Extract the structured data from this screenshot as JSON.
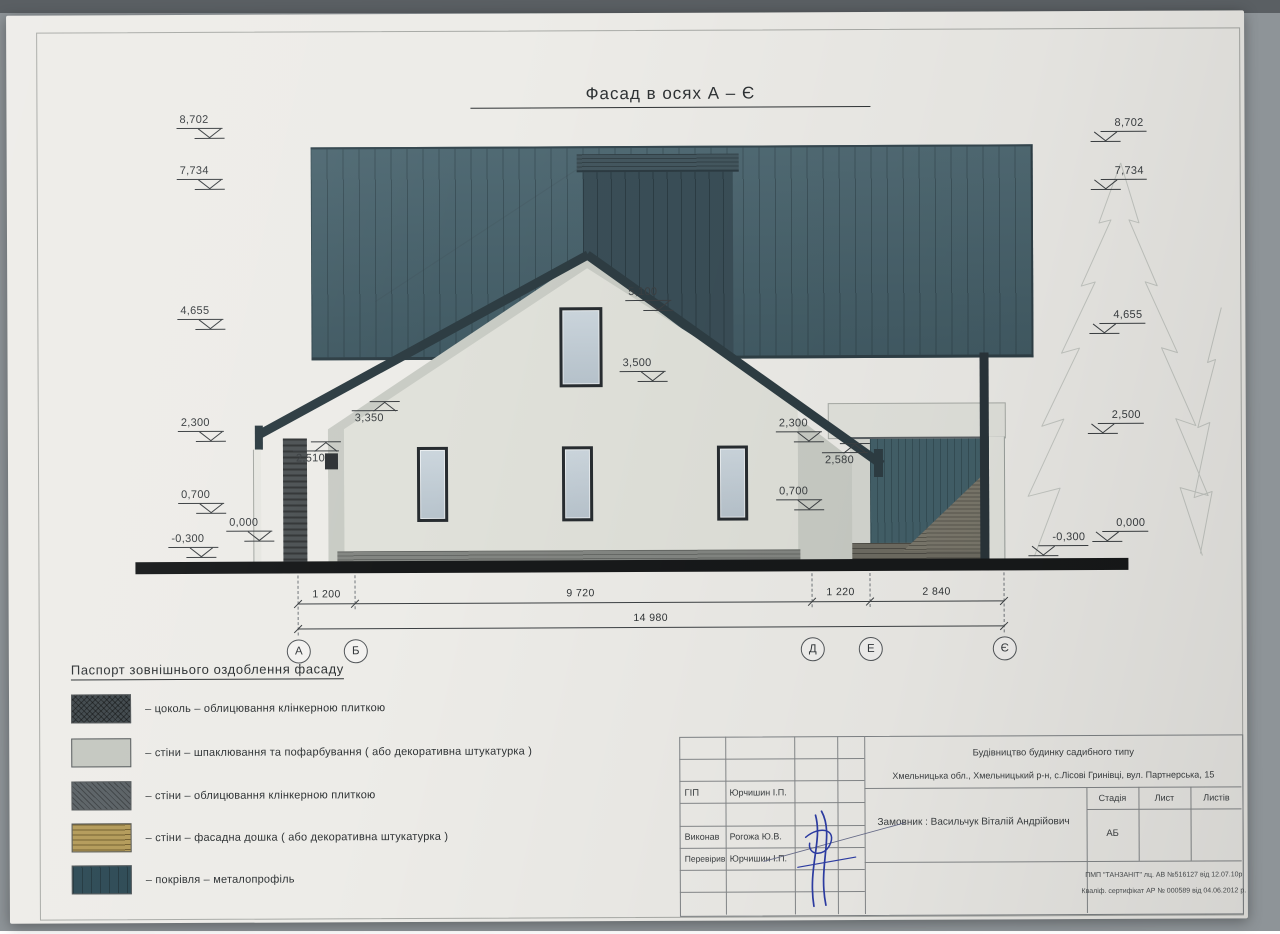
{
  "palette": {
    "photo_bg": "#8e9498",
    "photo_top": "#5a5f63",
    "paper": "#edece8",
    "line": "#3c4043",
    "roof": "#47626c",
    "roof_edge": "#2e3d43",
    "roof_dark": "#3a4e57",
    "wall_light": "#e0e1da",
    "wall_mid": "#c9ccc5",
    "frame_dark": "#272c30",
    "brick_dark": "#4e5355",
    "metal_teal": "#436069",
    "brick_warm": "#7b786c",
    "board_tan": "#b39a58",
    "legend_dark": "#3e464a",
    "legend_wall": "#c4c7c0",
    "legend_wall_dark": "#596064",
    "legend_roof": "#2c4954",
    "ground": "#17191a",
    "signature": "#2d3da6",
    "tree": "#c5c8c3"
  },
  "title": "Фасад в осях  А – Є",
  "markers": {
    "left": [
      "8,702",
      "7,734",
      "4,655",
      "2,300",
      "0,700",
      "0,000",
      "-0,300"
    ],
    "right": [
      "8,702",
      "7,734",
      "4,655",
      "2,500",
      "0,000",
      "-0,300"
    ],
    "inner": [
      "5,100",
      "3,500",
      "3,350",
      "2,510",
      "2,300",
      "2,580",
      "0,700"
    ]
  },
  "dimensions": {
    "segments": [
      "1 200",
      "9 720",
      "1 220",
      "2 840"
    ],
    "total": "14 980"
  },
  "axes": [
    "А",
    "Б",
    "Д",
    "Е",
    "Є"
  ],
  "legend": {
    "title": "Паспорт зовнішнього оздоблення фасаду",
    "items": [
      "–  цоколь  –  облицювання клінкерною плиткою",
      "–  стіни  –  шпаклювання та пофарбування ( або декоративна штукатурка )",
      "–  стіни  –  облицювання клінкерною плиткою",
      "–  стіни  –  фасадна дошка ( або декоративна штукатурка )",
      "–  покрівля  –  металопрофіль"
    ]
  },
  "titleblock": {
    "project_line1": "Будівництво будинку садибного типу",
    "project_line2": "Хмельницька обл.,  Хмельницький р-н,  с.Лісові Гринівці,  вул. Партнерська, 15",
    "client": "Замовник :  Васильчук Віталій Андрійович",
    "roles": [
      {
        "role": "ГІП",
        "name": "Юрчишин І.П."
      },
      {
        "role": "Виконав",
        "name": "Рогожа Ю.В."
      },
      {
        "role": "Перевірив",
        "name": "Юрчишин І.П."
      }
    ],
    "stage_header": "Стадія",
    "sheet_header": "Лист",
    "sheets_header": "Листів",
    "stage_value": "АБ",
    "license_line1": "ПМП \"ТАНЗАНІТ\"  лц. АВ №516127 від 12.07.10р",
    "license_line2": "Кваліф. сертифікат АР № 000589 від 04.06.2012 р."
  }
}
